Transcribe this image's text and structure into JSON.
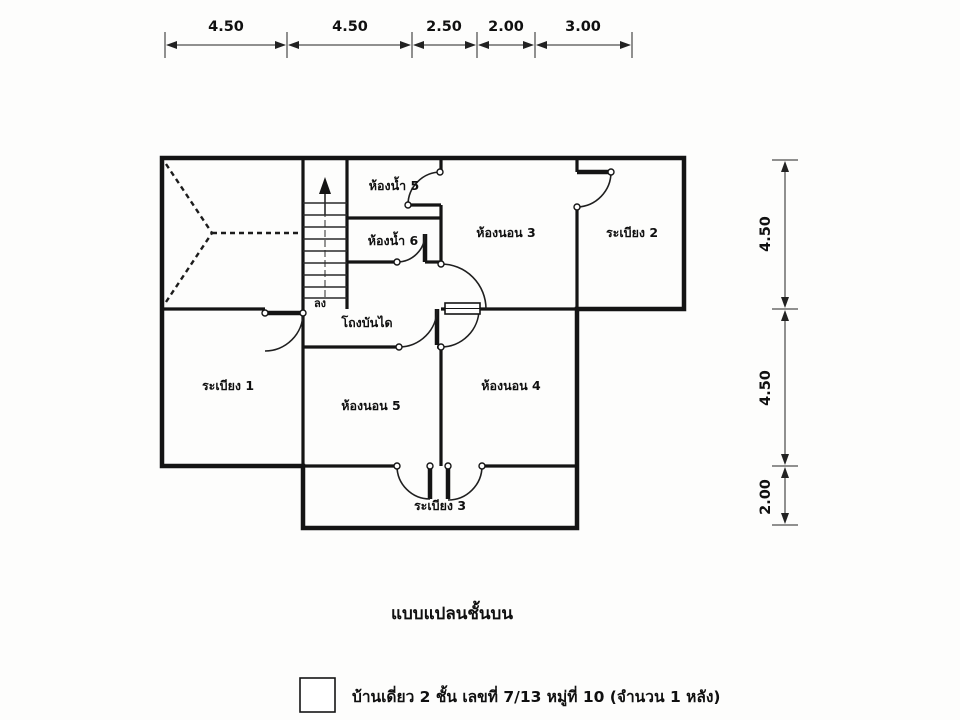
{
  "caption": "แบบแปลนชั้นบน",
  "legend": {
    "label": "บ้านเดี่ยว 2 ชั้น เลขที่ 7/13 หมู่ที่ 10 (จำนวน 1 หลัง)"
  },
  "dimensions": {
    "top": [
      "4.50",
      "4.50",
      "2.50",
      "2.00",
      "3.00"
    ],
    "right": [
      "4.50",
      "4.50",
      "2.00"
    ]
  },
  "plan": {
    "rooms": {
      "bathroom5": "ห้องน้ำ 5",
      "bathroom6": "ห้องน้ำ 6",
      "bedroom3": "ห้องนอน 3",
      "bedroom4": "ห้องนอน 4",
      "bedroom5": "ห้องนอน 5",
      "balcony1": "ระเบียง 1",
      "balcony2": "ระเบียง 2",
      "balcony3": "ระเบียง 3",
      "stair_hall": "โถงบันได"
    },
    "stairs": {
      "direction_label": "ลง"
    }
  }
}
